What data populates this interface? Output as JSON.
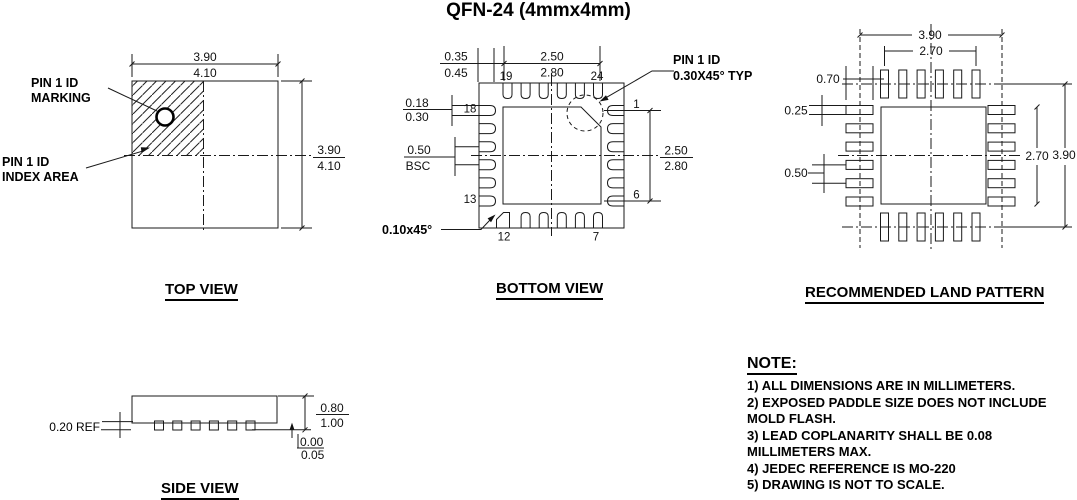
{
  "title": "QFN-24 (4mmx4mm)",
  "top_view": {
    "caption": "TOP VIEW",
    "pin1_marking_label": [
      "PIN 1 ID",
      "MARKING"
    ],
    "pin1_index_label": [
      "PIN 1 ID",
      "INDEX AREA"
    ],
    "dim_width": [
      "3.90",
      "4.10"
    ],
    "dim_height": [
      "3.90",
      "4.10"
    ]
  },
  "bottom_view": {
    "caption": "BOTTOM VIEW",
    "dim_corner_lead": [
      "0.35",
      "0.45"
    ],
    "dim_epad_width": [
      "2.50",
      "2.80"
    ],
    "dim_lead_width": [
      "0.18",
      "0.30"
    ],
    "dim_pitch": [
      "0.50",
      "BSC"
    ],
    "dim_epad_height": [
      "2.50",
      "2.80"
    ],
    "chamfer_label": "0.10x45°",
    "pin1_id_label": [
      "PIN 1 ID",
      "0.30X45° TYP"
    ],
    "pins": {
      "p1": "1",
      "p6": "6",
      "p7": "7",
      "p12": "12",
      "p13": "13",
      "p18": "18",
      "p19": "19",
      "p24": "24"
    }
  },
  "land_pattern": {
    "caption": "RECOMMENDED LAND PATTERN",
    "dim_outer_width": "3.90",
    "dim_inner_width": "2.70",
    "dim_pad_length": "0.70",
    "dim_pad_width": "0.25",
    "dim_pitch": "0.50",
    "dim_inner_height": "2.70",
    "dim_outer_height": "3.90"
  },
  "side_view": {
    "caption": "SIDE VIEW",
    "dim_lead_thickness": "0.20 REF",
    "dim_height": [
      "0.80",
      "1.00"
    ],
    "dim_standoff": [
      "0.00",
      "0.05"
    ]
  },
  "notes": {
    "heading": "NOTE:",
    "items": [
      "1) ALL DIMENSIONS ARE IN MILLIMETERS.",
      "2) EXPOSED PADDLE SIZE DOES NOT INCLUDE MOLD FLASH.",
      "3) LEAD COPLANARITY SHALL BE 0.08 MILLIMETERS MAX.",
      "4) JEDEC REFERENCE IS MO-220",
      "5) DRAWING IS NOT TO SCALE."
    ]
  }
}
